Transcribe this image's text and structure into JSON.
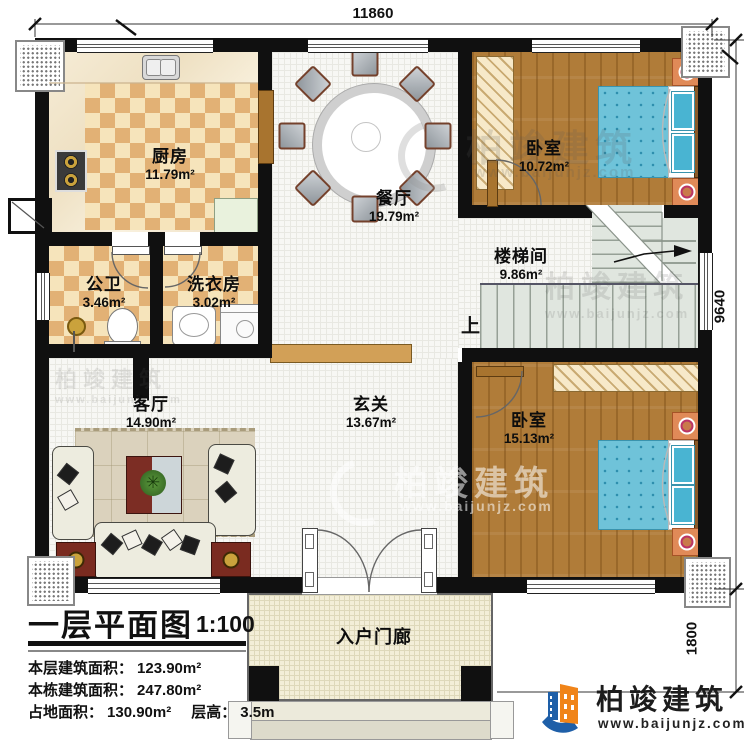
{
  "dims": {
    "top": "11860",
    "side": "9640",
    "porch": "1800"
  },
  "rooms": {
    "kitchen": {
      "name": "厨房",
      "area": "11.79m²"
    },
    "dining": {
      "name": "餐厅",
      "area": "19.79m²"
    },
    "bedroom1": {
      "name": "卧室",
      "area": "10.72m²"
    },
    "stairwell": {
      "name": "楼梯间",
      "area": "9.86m²"
    },
    "bathroom": {
      "name": "公卫",
      "area": "3.46m²"
    },
    "laundry": {
      "name": "洗衣房",
      "area": "3.02m²"
    },
    "living": {
      "name": "客厅",
      "area": "14.90m²"
    },
    "foyer": {
      "name": "玄关",
      "area": "13.67m²"
    },
    "bedroom2": {
      "name": "卧室",
      "area": "15.13m²"
    },
    "porch": {
      "name": "入户门廊"
    }
  },
  "stairs": {
    "up": "上"
  },
  "title_block": {
    "title": "一层平面图",
    "scale": "1:100",
    "rows": [
      {
        "label": "本层建筑面积：",
        "value": "123.90m²"
      },
      {
        "label": "本栋建筑面积：",
        "value": "247.80m²"
      },
      {
        "label": "占地面积：",
        "value": "130.90m²",
        "label2": "层高：",
        "value2": "3.5m"
      }
    ]
  },
  "branding": {
    "name": "柏竣建筑",
    "url": "www.baijunjz.com"
  },
  "watermark": {
    "name": "柏竣建筑",
    "url": "www.baijunjz.com"
  },
  "colors": {
    "wall": "#101010",
    "checker_dark": "#e2b175",
    "checker_light": "#f6e4bb",
    "wood": "#b07c39",
    "bed_blue": "#6fc3d9",
    "stair": "#e0e6df",
    "brand_blue": "#1e5fa8",
    "brand_orange": "#f08419"
  }
}
